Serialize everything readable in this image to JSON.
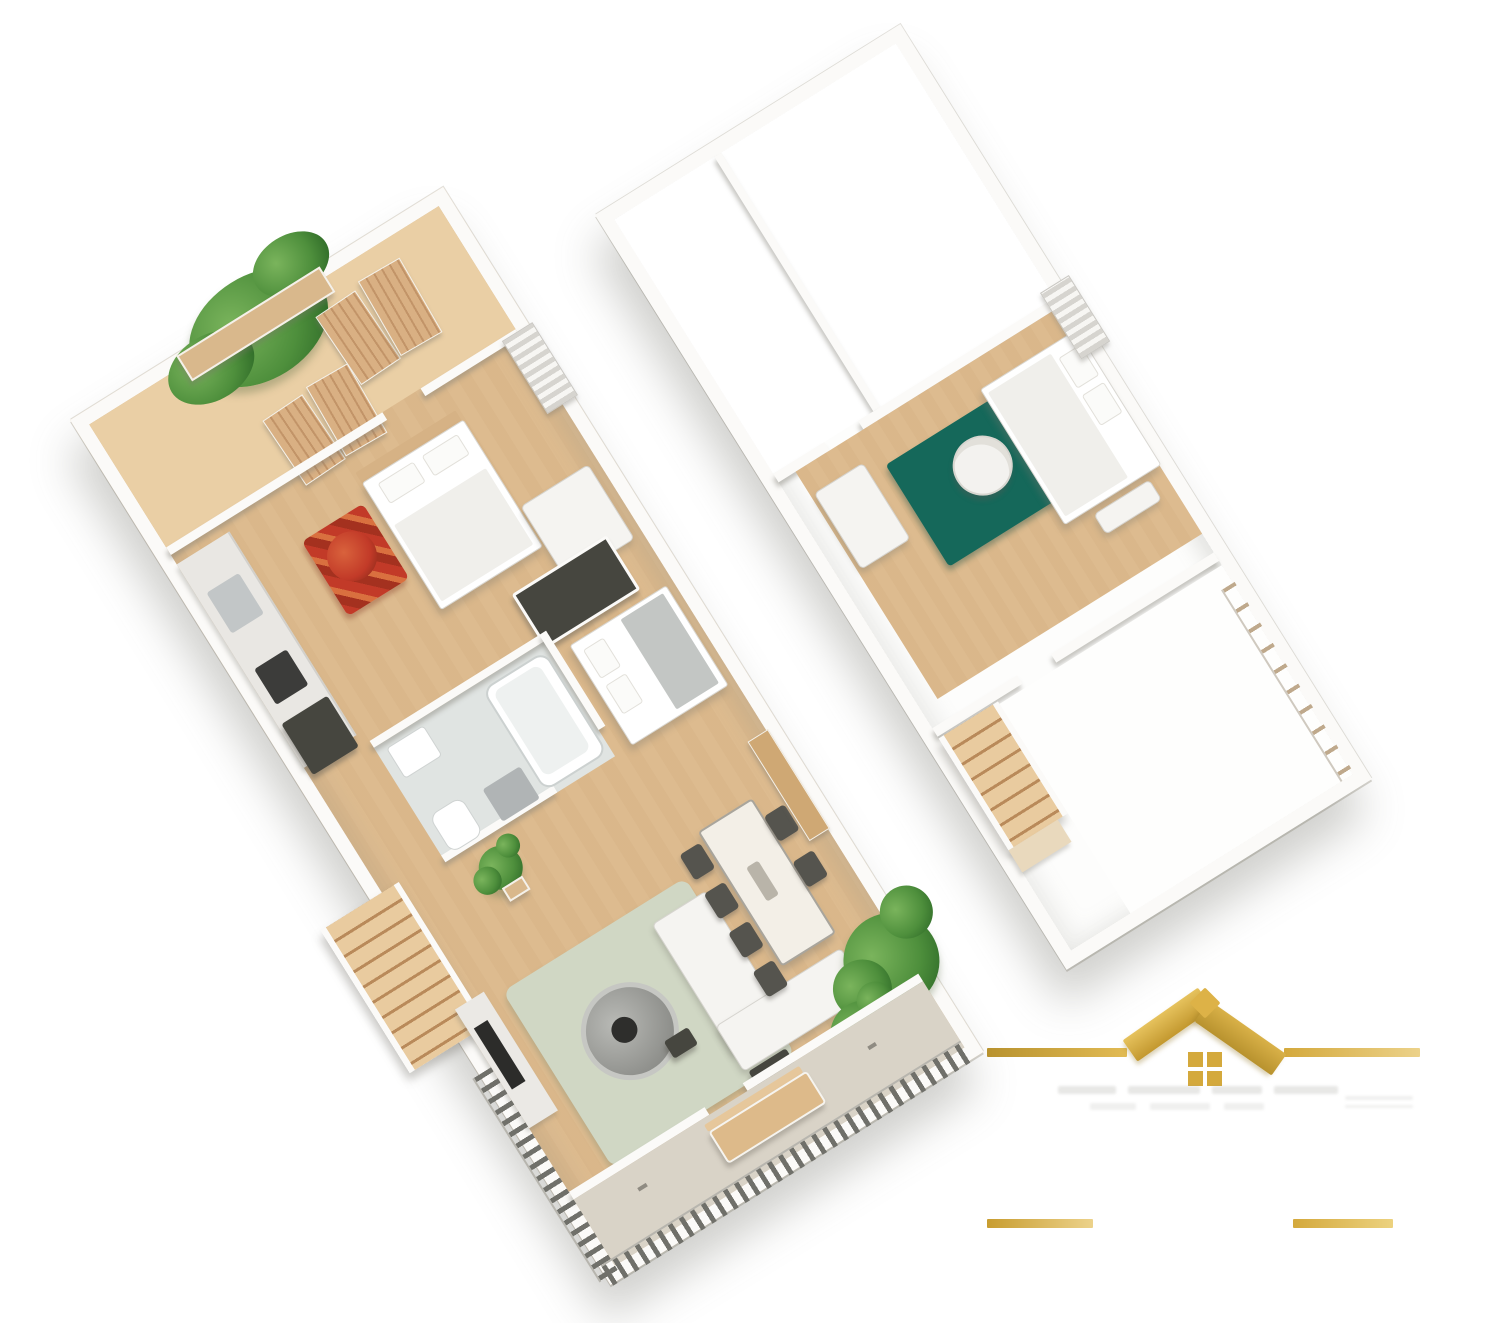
{
  "scene": {
    "type": "3d-isometric-floor-plan-render",
    "background": "#ffffff",
    "slab_rotation_deg": -32,
    "units_count": 2
  },
  "palette": {
    "wall": "#fbfaf8",
    "wood_floor": "#ddbb8f",
    "terrace_floor": "#eacfa5",
    "bathroom_floor": "#e0e4e2",
    "balcony_stone": "#d9d3c7",
    "white_room": "#fdfdfc",
    "teal_rug": "#15685a",
    "sage_rug": "#d0d7c4",
    "red_accent": "#c23a28",
    "plant_green": "#4e8f3c",
    "plant_dark": "#2f6b28",
    "stair_dark": "#b98a5a",
    "railing_gray": "#70706a",
    "appliance_dark": "#46463f",
    "gold": "#d4a93c",
    "gold_light": "#ecd28a",
    "gold_dark": "#b8922e"
  },
  "units": [
    {
      "id": "left-unit",
      "position": "lower-left",
      "rooms": [
        "terrace-with-plant",
        "bedroom-1",
        "kitchen",
        "bathroom",
        "bedroom-2",
        "staircase",
        "living-room",
        "dining-area",
        "balcony"
      ],
      "furniture": [
        "privacy-slat-panels",
        "double-bed",
        "red-armchair-and-rug",
        "white-wardrobe",
        "kitchen-counter-with-sink-and-cooktop",
        "fridge",
        "dark-closet",
        "bathtub",
        "washbasin",
        "toilet",
        "washing-machine",
        "second-bed",
        "potted-plant",
        "media-unit-with-tv",
        "round-pouf",
        "corner-sofa",
        "dining-table-with-chairs",
        "sideboard",
        "outdoor-bench",
        "balcony-railing",
        "shrubs"
      ]
    },
    {
      "id": "right-unit",
      "position": "upper-right",
      "rooms": [
        "empty-room-1",
        "empty-room-2",
        "furnished-bedroom",
        "staircase",
        "open-room-with-balustrade"
      ],
      "furniture": [
        "double-bed",
        "teal-rug",
        "round-chair",
        "desk",
        "dark-teal-beanbag",
        "louvered-shutter",
        "wood-stairs",
        "edge-balustrade"
      ]
    }
  ],
  "branding": {
    "glyph": "gold-house-roof-with-four-pane-window",
    "divider_lines": 2,
    "footer_bars": 2,
    "watermark_text_visible": true,
    "watermark_text_legible": false
  }
}
